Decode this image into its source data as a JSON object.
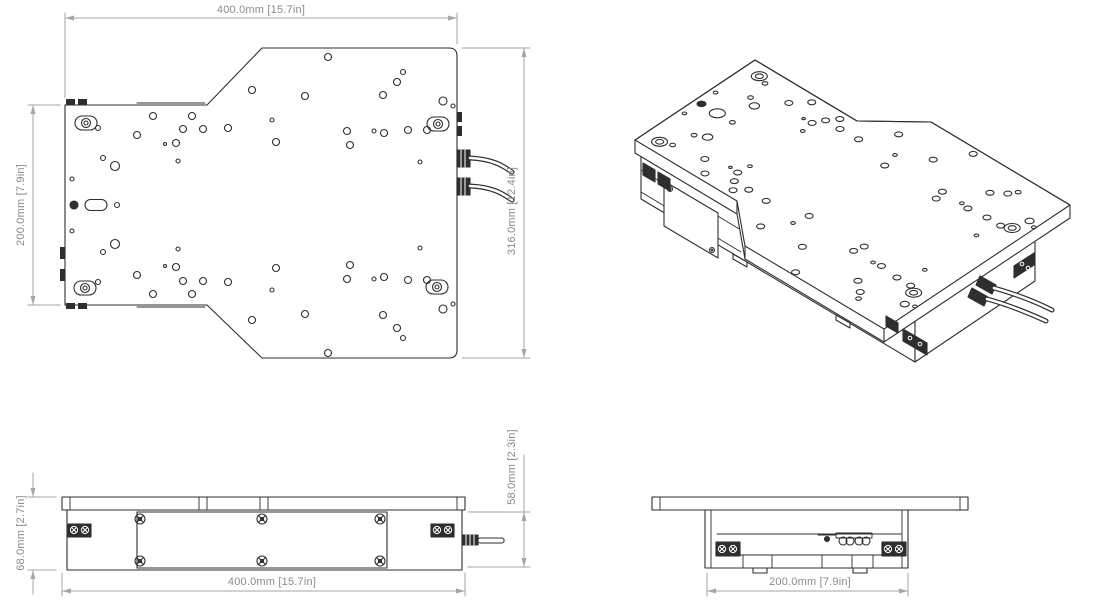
{
  "document": {
    "title": "stage-technical-drawing",
    "views": [
      "top-view",
      "isometric-view",
      "front-view",
      "side-view"
    ]
  },
  "colors": {
    "line": "#2e2e2e",
    "dim": "#a6a6a6",
    "dim_text": "#8a8a8a",
    "bg": "#ffffff"
  },
  "dims": {
    "top_width": "400.0mm [15.7in]",
    "left_depth": "200.0mm [7.9in]",
    "right_depth": "316.0mm [12.4in]",
    "front_total_height": "68.0mm [2.7in]",
    "front_body_height": "58.0mm [2.3in]",
    "front_width": "400.0mm [15.7in]",
    "side_depth": "200.0mm [7.9in]"
  },
  "geometry": {
    "dim_lines": [
      "M65 13 L65 98",
      "M457 13 L457 44",
      "M65 18 L457 18",
      "M28 105 L60 105",
      "M28 305 L60 305",
      "M33 105 L33 305",
      "M462 48 L530 48",
      "M462 358 L530 358",
      "M524 48 L524 358",
      "M28 497 L56 497",
      "M28 570 L56 570",
      "M33 473 L33 497",
      "M33 570 L33 594",
      "M468 512 L530 512",
      "M468 567 L530 567",
      "M524 455 L524 567",
      "M62 573 L62 596",
      "M465 573 L465 596",
      "M62 591 L465 591",
      "M707 573 L707 596",
      "M908 573 L908 596",
      "M707 591 L908 591"
    ],
    "dim_arrows": [
      [
        65,
        18,
        74,
        15.5,
        74,
        20.5
      ],
      [
        457,
        18,
        448,
        15.5,
        448,
        20.5
      ],
      [
        33,
        105,
        30.5,
        114,
        35.5,
        114
      ],
      [
        33,
        305,
        30.5,
        296,
        35.5,
        296
      ],
      [
        524,
        48,
        521.5,
        57,
        526.5,
        57
      ],
      [
        524,
        358,
        521.5,
        349,
        526.5,
        349
      ],
      [
        33,
        497,
        30.5,
        488,
        35.5,
        488
      ],
      [
        33,
        570,
        30.5,
        579,
        35.5,
        579
      ],
      [
        524,
        512,
        521.5,
        521,
        526.5,
        521
      ],
      [
        524,
        567,
        521.5,
        558,
        526.5,
        558
      ],
      [
        62,
        591,
        71,
        588.5,
        71,
        593.5
      ],
      [
        465,
        591,
        456,
        588.5,
        456,
        593.5
      ],
      [
        707,
        591,
        716,
        588.5,
        716,
        593.5
      ],
      [
        908,
        591,
        899,
        588.5,
        899,
        593.5
      ]
    ],
    "topview": {
      "outline": "M65 105 L207 105 L262 48 L449 48 Q457 48 457 56 L457 350 Q457 358 449 358 L262 358 L207 305 L65 305 Z",
      "lips": [
        "M137 103 L205 103",
        "M137 307 L205 307"
      ],
      "tabs": [
        [
          66,
          99,
          9,
          6
        ],
        [
          78,
          99,
          9,
          6
        ],
        [
          66,
          303,
          9,
          6
        ],
        [
          78,
          303,
          9,
          6
        ],
        [
          60,
          247,
          5,
          12
        ],
        [
          60,
          269,
          5,
          12
        ],
        [
          457,
          112,
          5,
          10
        ],
        [
          457,
          126,
          5,
          10
        ]
      ],
      "conns": [
        [
          457,
          150,
          13,
          17
        ],
        [
          457,
          178,
          13,
          17
        ]
      ],
      "cables": [
        "M470 158 C492 159 502 165 512 172",
        "M470 186 C492 187 502 193 512 200"
      ],
      "holes": [
        [
          328,
          57,
          3.5
        ],
        [
          252,
          90,
          3.5
        ],
        [
          305,
          96,
          3.5
        ],
        [
          403,
          72,
          2.5
        ],
        [
          397,
          82,
          3.5
        ],
        [
          383,
          95,
          3.5
        ],
        [
          443,
          101,
          4
        ],
        [
          453,
          106,
          2
        ],
        [
          272,
          120,
          2
        ],
        [
          347,
          131,
          3.5
        ],
        [
          374,
          131,
          2
        ],
        [
          384,
          133,
          3.5
        ],
        [
          408,
          130,
          3.5
        ],
        [
          427,
          130,
          3.5
        ],
        [
          276,
          142,
          3.5
        ],
        [
          350,
          145,
          3.5
        ],
        [
          420,
          162,
          2
        ],
        [
          153,
          116,
          3.5
        ],
        [
          192,
          116,
          3.5
        ],
        [
          98,
          128,
          2.5
        ],
        [
          137,
          135,
          3.5
        ],
        [
          183,
          129,
          3.5
        ],
        [
          203,
          129,
          3.5
        ],
        [
          228,
          128,
          3.5
        ],
        [
          165,
          144,
          1.5
        ],
        [
          176,
          143,
          3.5
        ],
        [
          103,
          158,
          2.5
        ],
        [
          115,
          166,
          4.5
        ],
        [
          178,
          161,
          2
        ],
        [
          72,
          179,
          2
        ],
        [
          117,
          205,
          2.5
        ],
        [
          328,
          353,
          3.5
        ],
        [
          252,
          320,
          3.5
        ],
        [
          305,
          314,
          3.5
        ],
        [
          403,
          338,
          2.5
        ],
        [
          397,
          328,
          3.5
        ],
        [
          383,
          315,
          3.5
        ],
        [
          443,
          309,
          4
        ],
        [
          453,
          304,
          2
        ],
        [
          272,
          290,
          2
        ],
        [
          347,
          279,
          3.5
        ],
        [
          374,
          279,
          2
        ],
        [
          384,
          277,
          3.5
        ],
        [
          408,
          280,
          3.5
        ],
        [
          427,
          280,
          3.5
        ],
        [
          276,
          268,
          3.5
        ],
        [
          350,
          265,
          3.5
        ],
        [
          420,
          248,
          2
        ],
        [
          153,
          294,
          3.5
        ],
        [
          192,
          294,
          3.5
        ],
        [
          98,
          282,
          2.5
        ],
        [
          137,
          275,
          3.5
        ],
        [
          183,
          281,
          3.5
        ],
        [
          203,
          281,
          3.5
        ],
        [
          228,
          282,
          3.5
        ],
        [
          165,
          266,
          1.5
        ],
        [
          176,
          267,
          3.5
        ],
        [
          103,
          252,
          2.5
        ],
        [
          115,
          244,
          4.5
        ],
        [
          178,
          249,
          2
        ],
        [
          72,
          231,
          2
        ]
      ],
      "slots": [
        [
          86,
          123
        ],
        [
          438,
          124
        ],
        [
          85,
          288
        ],
        [
          437,
          287
        ]
      ],
      "pin": [
        74,
        205
      ],
      "pin_slot": [
        88,
        205
      ]
    },
    "front": {
      "plate": [
        62,
        497,
        403,
        13
      ],
      "plate_ticks": [
        70,
        457,
        199,
        207,
        260,
        268
      ],
      "body": [
        67,
        510,
        395,
        60
      ],
      "panel": [
        137,
        512,
        250,
        56
      ],
      "panel_screws": [
        [
          140,
          519
        ],
        [
          262,
          519
        ],
        [
          380,
          519
        ],
        [
          140,
          561
        ],
        [
          262,
          561
        ],
        [
          380,
          561
        ]
      ],
      "blocks": [
        [
          68,
          524
        ],
        [
          431,
          524
        ]
      ],
      "block_screws": [
        [
          74,
          530
        ],
        [
          85,
          530
        ],
        [
          437,
          530
        ],
        [
          448,
          530
        ]
      ],
      "connector": [
        462,
        535,
        16,
        10
      ],
      "rod": [
        478,
        538,
        26,
        5
      ]
    },
    "side": {
      "plate": [
        652,
        497,
        316,
        13
      ],
      "plate_ticks": [
        660,
        960
      ],
      "body": [
        705,
        510,
        203,
        58
      ],
      "body_inner": [
        711,
        902
      ],
      "rail_y": 534,
      "shelf_y": 555,
      "shelf_divs": [
        743,
        772,
        822,
        852,
        873
      ],
      "blocks": [
        [
          716,
          542
        ],
        [
          882,
          542
        ]
      ],
      "block_screws": [
        [
          722,
          549
        ],
        [
          733,
          549
        ],
        [
          888,
          549
        ],
        [
          899,
          549
        ]
      ],
      "grommet_bar": [
        836,
        533,
        36,
        5
      ],
      "grommets": [
        [
          843,
          541
        ],
        [
          850,
          541
        ],
        [
          859,
          541
        ],
        [
          866,
          541
        ]
      ],
      "pin": [
        827,
        539
      ],
      "pin_bar": [
        818,
        535,
        836,
        535
      ],
      "feet": [
        [
          753,
          568,
          14,
          5
        ],
        [
          853,
          568,
          14,
          5
        ]
      ]
    },
    "iso": {
      "affine": {
        "ox": 65,
        "oy": 105,
        "px": 755,
        "py": 60,
        "ax": 0.72,
        "ay": 0.43,
        "bx": -0.6,
        "by": 0.4
      },
      "slab": [
        [
          635,
          140
        ],
        [
          755,
          60
        ],
        [
          857,
          121
        ],
        [
          931,
          122
        ],
        [
          1070,
          205
        ],
        [
          1070,
          218
        ],
        [
          884,
          342
        ],
        [
          745,
          259
        ],
        [
          737,
          214
        ],
        [
          635,
          153
        ]
      ],
      "face": [
        [
          635,
          140
        ],
        [
          755,
          60
        ],
        [
          857,
          121
        ],
        [
          931,
          122
        ],
        [
          1070,
          205
        ],
        [
          884,
          329
        ],
        [
          745,
          246
        ],
        [
          737,
          201
        ]
      ],
      "inner_lines": [
        [
          737,
          201,
          737,
          214
        ],
        [
          745,
          246,
          745,
          259
        ],
        [
          884,
          329,
          884,
          342
        ]
      ],
      "base_near": [
        [
          641,
          154
        ],
        [
          915,
          317
        ],
        [
          915,
          362
        ],
        [
          641,
          199
        ]
      ],
      "base_stripes": [
        [
          641,
          170,
          741,
          230
        ],
        [
          641,
          192,
          741,
          252
        ]
      ],
      "base_right": [
        [
          915,
          317
        ],
        [
          1035,
          237
        ],
        [
          1035,
          281
        ],
        [
          915,
          362
        ]
      ],
      "panel": [
        [
          664,
          181
        ],
        [
          718,
          213
        ],
        [
          718,
          258
        ],
        [
          664,
          226
        ]
      ],
      "panel_screws": [
        [
          670,
          189
        ],
        [
          712,
          250
        ]
      ],
      "feet": [
        [
          [
            733,
            254
          ],
          [
            747,
            262
          ],
          [
            747,
            267
          ],
          [
            733,
            259
          ]
        ],
        [
          [
            836,
            315
          ],
          [
            850,
            323
          ],
          [
            850,
            328
          ],
          [
            836,
            320
          ]
        ]
      ],
      "blocks": [
        [
          [
            643,
            163
          ],
          [
            655,
            170
          ],
          [
            655,
            182
          ],
          [
            643,
            175
          ]
        ],
        [
          [
            658,
            172
          ],
          [
            670,
            179
          ],
          [
            670,
            191
          ],
          [
            658,
            184
          ]
        ],
        [
          [
            886,
            316
          ],
          [
            898,
            323
          ],
          [
            898,
            333
          ],
          [
            886,
            326
          ]
        ],
        [
          [
            903,
            329
          ],
          [
            927,
            343
          ],
          [
            927,
            355
          ],
          [
            903,
            341
          ]
        ],
        [
          [
            1014,
            266
          ],
          [
            1034,
            253
          ],
          [
            1034,
            265
          ],
          [
            1014,
            278
          ]
        ]
      ],
      "block_dots": [
        [
          910,
          338
        ],
        [
          920,
          344
        ],
        [
          1022,
          264
        ],
        [
          1028,
          268
        ]
      ],
      "conn_quads": [
        [
          [
            980,
            276
          ],
          [
            996,
            285
          ],
          [
            992,
            294
          ],
          [
            976,
            285
          ]
        ],
        [
          [
            972,
            288
          ],
          [
            988,
            297
          ],
          [
            984,
            306
          ],
          [
            968,
            297
          ]
        ]
      ],
      "cables": [
        "M994 288 C1012 293 1032 300 1052 310",
        "M987 299 C1006 304 1026 312 1046 321"
      ]
    }
  }
}
